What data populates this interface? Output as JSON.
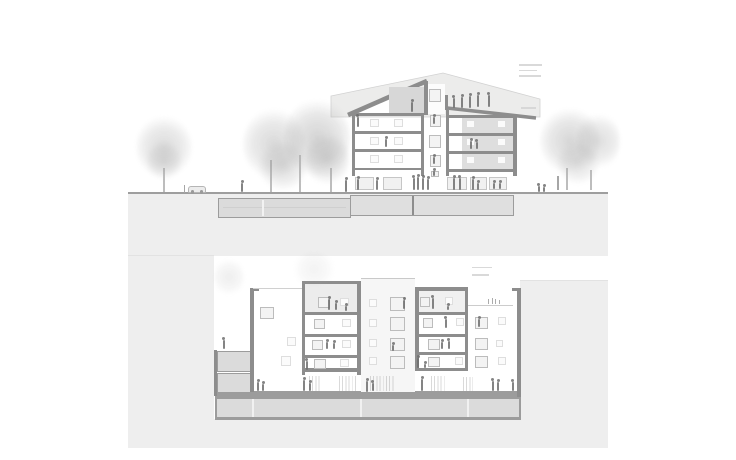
{
  "page": {
    "kind": "architectural-section-sheet",
    "drawing_count": 2
  },
  "colors": {
    "cut": "#8d8d8d",
    "cut_soft": "#9c9c9c",
    "terrain": "#eeeeee",
    "fill_mid": "#dbdbdb",
    "fill_attic": "#ececec",
    "fig": "#6f6f6f",
    "win_border": "#bcbcbc",
    "annotation": "#d5d5d5"
  },
  "sprites": {
    "upper_annotations": {
      "cls": "bar",
      "items": [
        {
          "x": 519,
          "y": 64,
          "w": 23
        },
        {
          "x": 519,
          "y": 69.5,
          "w": 18
        },
        {
          "x": 519,
          "y": 75,
          "w": 22
        },
        {
          "x": 521,
          "y": 107,
          "w": 15
        }
      ]
    },
    "lower_annotations": {
      "cls": "bar",
      "items": [
        {
          "x": 472,
          "y": 266.5,
          "w": 20
        },
        {
          "x": 472,
          "y": 274,
          "w": 17
        }
      ]
    },
    "upper_trees": {
      "cls": "tree",
      "items": [
        {
          "x": 136,
          "y": 116,
          "w": 56,
          "h": 62,
          "o": 0.75
        },
        {
          "x": 146,
          "y": 140,
          "w": 36,
          "h": 40,
          "o": 0.6
        },
        {
          "x": 243,
          "y": 108,
          "w": 62,
          "h": 72,
          "o": 0.8
        },
        {
          "x": 284,
          "y": 98,
          "w": 66,
          "h": 80,
          "o": 0.9
        },
        {
          "x": 258,
          "y": 140,
          "w": 50,
          "h": 50,
          "o": 0.7
        },
        {
          "x": 305,
          "y": 130,
          "w": 44,
          "h": 56,
          "o": 0.8
        },
        {
          "x": 540,
          "y": 108,
          "w": 60,
          "h": 66,
          "o": 0.85
        },
        {
          "x": 576,
          "y": 112,
          "w": 44,
          "h": 58,
          "o": 0.7
        },
        {
          "x": 556,
          "y": 140,
          "w": 44,
          "h": 44,
          "o": 0.6
        }
      ]
    },
    "lower_trees": {
      "cls": "tree",
      "items": [
        {
          "x": 214,
          "y": 258,
          "w": 30,
          "h": 38,
          "o": 0.35
        },
        {
          "x": 292,
          "y": 252,
          "w": 44,
          "h": 34,
          "o": 0.25
        }
      ]
    },
    "upper_trunks": {
      "cls": "trunk",
      "items": [
        {
          "x": 163,
          "y": 168,
          "h": 24
        },
        {
          "x": 270,
          "y": 160,
          "h": 32
        },
        {
          "x": 299,
          "y": 155,
          "h": 37
        },
        {
          "x": 330,
          "y": 168,
          "h": 24
        },
        {
          "x": 566,
          "y": 168,
          "h": 22
        },
        {
          "x": 590,
          "y": 170,
          "h": 20
        }
      ]
    },
    "upper_posts": {
      "cls": "post",
      "items": [
        {
          "x": 557,
          "y": 176,
          "h": 14
        },
        {
          "x": 183.5,
          "y": 185,
          "h": 8
        }
      ]
    },
    "upper_stair_windows": {
      "cls": "win",
      "items": [
        {
          "x": 429,
          "y": 89,
          "w": 12,
          "h": 13
        },
        {
          "x": 429.5,
          "y": 115,
          "w": 11,
          "h": 12
        },
        {
          "x": 428.5,
          "y": 135,
          "w": 12,
          "h": 13
        },
        {
          "x": 429.5,
          "y": 155,
          "w": 11,
          "h": 12
        },
        {
          "x": 431,
          "y": 170.5,
          "w": 8,
          "h": 6.5
        }
      ]
    },
    "upper_room_windows": {
      "cls": "winc",
      "items": [
        {
          "x": 370,
          "y": 119,
          "w": 9,
          "h": 8
        },
        {
          "x": 394,
          "y": 119,
          "w": 9,
          "h": 8
        },
        {
          "x": 370,
          "y": 137,
          "w": 9,
          "h": 8
        },
        {
          "x": 394,
          "y": 137,
          "w": 9,
          "h": 8
        },
        {
          "x": 370,
          "y": 155,
          "w": 9,
          "h": 8
        },
        {
          "x": 394,
          "y": 155,
          "w": 9,
          "h": 8
        },
        {
          "x": 466,
          "y": 120,
          "w": 9,
          "h": 8
        },
        {
          "x": 497,
          "y": 120,
          "w": 9,
          "h": 8
        },
        {
          "x": 466,
          "y": 138,
          "w": 9,
          "h": 8
        },
        {
          "x": 497,
          "y": 138,
          "w": 9,
          "h": 8
        },
        {
          "x": 466,
          "y": 156,
          "w": 9,
          "h": 8
        },
        {
          "x": 497,
          "y": 156,
          "w": 9,
          "h": 8
        }
      ]
    },
    "upper_storefronts": {
      "cls": "store",
      "items": [
        {
          "x": 355,
          "y": 176.5,
          "w": 19,
          "h": 13.5
        },
        {
          "x": 382.5,
          "y": 176.5,
          "w": 19.5,
          "h": 13.5
        },
        {
          "x": 447,
          "y": 176.5,
          "w": 20,
          "h": 13.5
        },
        {
          "x": 469.5,
          "y": 176.5,
          "w": 17,
          "h": 13.5
        },
        {
          "x": 489,
          "y": 176.5,
          "w": 18,
          "h": 13.5
        }
      ]
    },
    "upper_people": {
      "cls": "person",
      "items": [
        {
          "x": 241,
          "y": 183,
          "h": 9
        },
        {
          "x": 345,
          "y": 180,
          "h": 11.5
        },
        {
          "x": 537.5,
          "y": 186,
          "h": 6
        },
        {
          "x": 543,
          "y": 187,
          "h": 5
        },
        {
          "x": 357,
          "y": 178.5,
          "h": 11
        },
        {
          "x": 376,
          "y": 179.5,
          "h": 10
        },
        {
          "x": 412.5,
          "y": 177.5,
          "h": 12
        },
        {
          "x": 417,
          "y": 176.5,
          "h": 13
        },
        {
          "x": 422,
          "y": 177.5,
          "h": 12
        },
        {
          "x": 427,
          "y": 178.5,
          "h": 11
        },
        {
          "x": 453,
          "y": 177.5,
          "h": 12
        },
        {
          "x": 458.5,
          "y": 177.5,
          "h": 12
        },
        {
          "x": 472,
          "y": 178.5,
          "h": 11
        },
        {
          "x": 477,
          "y": 182.5,
          "h": 7
        },
        {
          "x": 493,
          "y": 182.5,
          "h": 6.5
        },
        {
          "x": 499,
          "y": 182.5,
          "h": 6.5
        },
        {
          "x": 452.5,
          "y": 97.5,
          "h": 10.5
        },
        {
          "x": 461,
          "y": 96.5,
          "h": 11
        },
        {
          "x": 469,
          "y": 95.5,
          "h": 12
        },
        {
          "x": 477,
          "y": 94.5,
          "h": 12
        },
        {
          "x": 487.5,
          "y": 95,
          "h": 12
        },
        {
          "x": 411,
          "y": 101.5,
          "h": 10
        },
        {
          "x": 356.5,
          "y": 116.5,
          "h": 10
        },
        {
          "x": 385,
          "y": 139,
          "h": 8
        },
        {
          "x": 470,
          "y": 140.5,
          "h": 8
        },
        {
          "x": 475.5,
          "y": 141.5,
          "h": 7
        },
        {
          "x": 433,
          "y": 116.5,
          "h": 7
        },
        {
          "x": 433,
          "y": 156.5,
          "h": 7
        },
        {
          "x": 433,
          "y": 171,
          "h": 4.5
        }
      ]
    },
    "lower_cut_windows": {
      "cls": "win",
      "items": [
        {
          "x": 318,
          "y": 297,
          "w": 12,
          "h": 11
        },
        {
          "x": 314,
          "y": 318.5,
          "w": 11,
          "h": 10
        },
        {
          "x": 311.5,
          "y": 340,
          "w": 11,
          "h": 10
        },
        {
          "x": 314,
          "y": 359,
          "w": 12,
          "h": 9.5
        },
        {
          "x": 420,
          "y": 296.5,
          "w": 10,
          "h": 10
        },
        {
          "x": 422.5,
          "y": 318,
          "w": 10,
          "h": 10
        },
        {
          "x": 428,
          "y": 338.5,
          "w": 12,
          "h": 11
        },
        {
          "x": 427.5,
          "y": 356.5,
          "w": 12,
          "h": 10
        },
        {
          "x": 389.5,
          "y": 296.5,
          "w": 15,
          "h": 14
        },
        {
          "x": 389.5,
          "y": 317,
          "w": 15,
          "h": 13.5
        },
        {
          "x": 389.5,
          "y": 337.5,
          "w": 15,
          "h": 13.5
        },
        {
          "x": 389.5,
          "y": 355.5,
          "w": 15,
          "h": 13
        },
        {
          "x": 260,
          "y": 306.5,
          "w": 13.5,
          "h": 12
        },
        {
          "x": 474.5,
          "y": 316.5,
          "w": 13,
          "h": 12
        },
        {
          "x": 474.5,
          "y": 338,
          "w": 13,
          "h": 12
        },
        {
          "x": 474.5,
          "y": 355.5,
          "w": 13,
          "h": 12
        }
      ]
    },
    "lower_faint_windows": {
      "cls": "winc",
      "items": [
        {
          "x": 340,
          "y": 297.5,
          "w": 9,
          "h": 8
        },
        {
          "x": 342,
          "y": 318.5,
          "w": 9,
          "h": 8
        },
        {
          "x": 342,
          "y": 340,
          "w": 9,
          "h": 8
        },
        {
          "x": 340,
          "y": 359,
          "w": 9,
          "h": 8
        },
        {
          "x": 368.5,
          "y": 298.5,
          "w": 8,
          "h": 8
        },
        {
          "x": 368.5,
          "y": 318.5,
          "w": 8,
          "h": 8
        },
        {
          "x": 368.5,
          "y": 338.5,
          "w": 8,
          "h": 8
        },
        {
          "x": 368.5,
          "y": 356.5,
          "w": 8,
          "h": 8
        },
        {
          "x": 445,
          "y": 296.5,
          "w": 8,
          "h": 8
        },
        {
          "x": 456,
          "y": 317.5,
          "w": 8,
          "h": 8
        },
        {
          "x": 455,
          "y": 356.5,
          "w": 8,
          "h": 8
        },
        {
          "x": 498,
          "y": 317,
          "w": 8,
          "h": 8
        },
        {
          "x": 496,
          "y": 340,
          "w": 7,
          "h": 7
        },
        {
          "x": 498,
          "y": 357,
          "w": 8,
          "h": 8
        },
        {
          "x": 287,
          "y": 337,
          "w": 9,
          "h": 9
        },
        {
          "x": 281,
          "y": 356,
          "w": 10,
          "h": 10
        }
      ]
    },
    "lower_hatches": {
      "cls": "hatch",
      "items": [
        {
          "x": 309,
          "y": 376,
          "w": 13,
          "h": 15
        },
        {
          "x": 339,
          "y": 376,
          "w": 18,
          "h": 15
        },
        {
          "x": 370,
          "y": 376,
          "w": 25,
          "h": 15
        },
        {
          "x": 431,
          "y": 376,
          "w": 16,
          "h": 15
        },
        {
          "x": 463,
          "y": 377,
          "w": 10,
          "h": 14
        }
      ]
    },
    "lower_people": {
      "cls": "person",
      "items": [
        {
          "x": 222.5,
          "y": 339.5,
          "h": 9
        },
        {
          "x": 257,
          "y": 381.5,
          "h": 9.5
        },
        {
          "x": 262,
          "y": 383.5,
          "h": 7.5
        },
        {
          "x": 303,
          "y": 379.5,
          "h": 11.5
        },
        {
          "x": 309,
          "y": 383,
          "h": 8
        },
        {
          "x": 366,
          "y": 380.5,
          "h": 11
        },
        {
          "x": 371.5,
          "y": 383,
          "h": 8
        },
        {
          "x": 421,
          "y": 378.5,
          "h": 12.5
        },
        {
          "x": 491.5,
          "y": 380.5,
          "h": 10.5
        },
        {
          "x": 497,
          "y": 381.5,
          "h": 9.5
        },
        {
          "x": 511.5,
          "y": 382,
          "h": 9
        },
        {
          "x": 328,
          "y": 298.5,
          "h": 11
        },
        {
          "x": 335,
          "y": 302.5,
          "h": 7
        },
        {
          "x": 345,
          "y": 305.5,
          "h": 5
        },
        {
          "x": 326,
          "y": 342,
          "h": 7
        },
        {
          "x": 333,
          "y": 343,
          "h": 6
        },
        {
          "x": 305.5,
          "y": 361,
          "h": 9
        },
        {
          "x": 403,
          "y": 299.5,
          "h": 9
        },
        {
          "x": 392,
          "y": 344.5,
          "h": 6
        },
        {
          "x": 431.5,
          "y": 297.5,
          "h": 11
        },
        {
          "x": 447,
          "y": 305.5,
          "h": 4.5
        },
        {
          "x": 444.5,
          "y": 318.5,
          "h": 9
        },
        {
          "x": 441,
          "y": 341.5,
          "h": 7
        },
        {
          "x": 447.5,
          "y": 340.5,
          "h": 8.5
        },
        {
          "x": 417,
          "y": 357.5,
          "h": 10
        },
        {
          "x": 424,
          "y": 363.5,
          "h": 4.5
        },
        {
          "x": 478,
          "y": 318.5,
          "h": 8
        }
      ]
    },
    "lower_roof_plants": {
      "cls": "plant",
      "items": [
        {
          "x": 488,
          "y": 299,
          "h": 5
        },
        {
          "x": 491.5,
          "y": 297.5,
          "h": 6.5
        },
        {
          "x": 495,
          "y": 299,
          "h": 5
        },
        {
          "x": 498.5,
          "y": 300,
          "h": 4
        }
      ]
    }
  }
}
